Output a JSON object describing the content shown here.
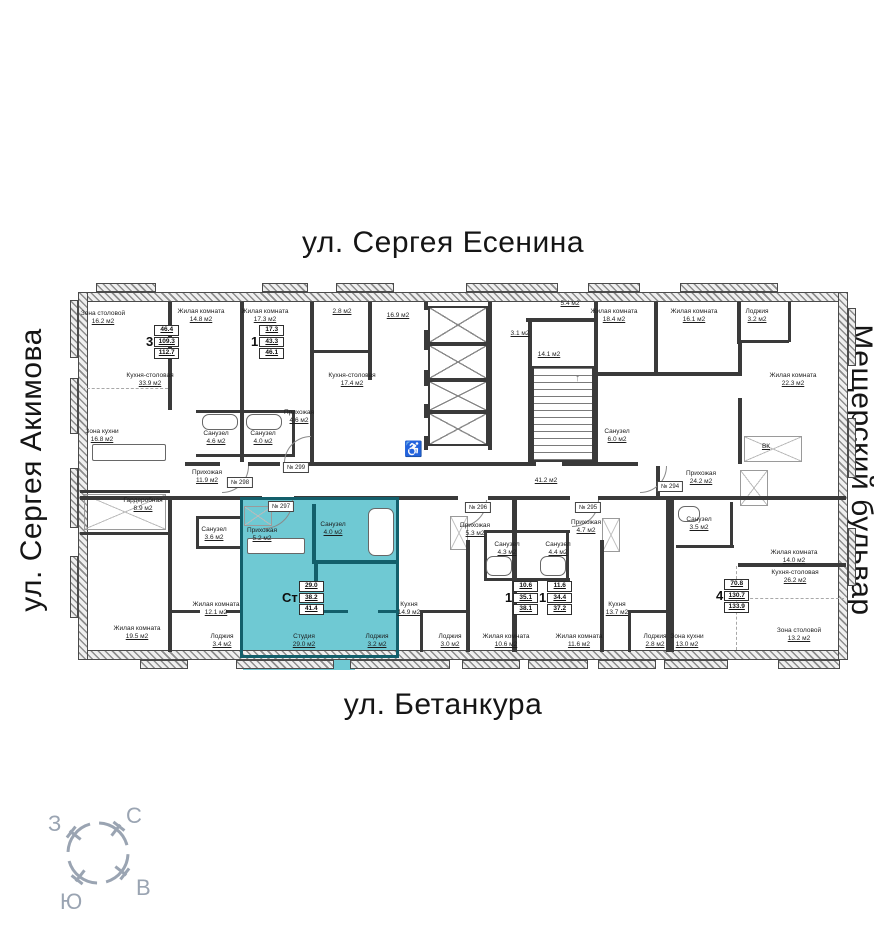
{
  "streets": {
    "top": "ул. Сергея Есенина",
    "bottom": "ул. Бетанкура",
    "left": "ул. Сергея Акимова",
    "right": "Мещерский бульвар"
  },
  "compass": {
    "north": "С",
    "south": "Ю",
    "west": "З",
    "east": "В"
  },
  "icons": {
    "wheelchair": "♿",
    "stair_arrow": "↑"
  },
  "colors": {
    "highlight_fill": "#6FC9D3",
    "highlight_wall": "#135F6B",
    "wall": "#3A3A3A",
    "accent_red": "#B31717",
    "compass_gray": "#9AA4B2"
  },
  "highlighted_unit": {
    "plate": "№ 297",
    "type": "Ст",
    "living_area": "29.0",
    "area": "38.2",
    "total_area": "41.4"
  },
  "plan": {
    "rooms": [
      {
        "n": "Зона столовой",
        "a": "16.2 м2",
        "x": 103,
        "y": 310
      },
      {
        "n": "Жилая комната",
        "a": "14.8 м2",
        "x": 201,
        "y": 308
      },
      {
        "n": "Жилая комната",
        "a": "17.3 м2",
        "x": 265,
        "y": 308
      },
      {
        "n": "",
        "a": "2.8 м2",
        "x": 342,
        "y": 308
      },
      {
        "n": "",
        "a": "16.9 м2",
        "x": 398,
        "y": 312
      },
      {
        "n": "",
        "a": "5.4 м2",
        "x": 570,
        "y": 300
      },
      {
        "n": "Жилая комната",
        "a": "18.4 м2",
        "x": 614,
        "y": 308
      },
      {
        "n": "Жилая комната",
        "a": "16.1 м2",
        "x": 694,
        "y": 308
      },
      {
        "n": "Лоджия",
        "a": "3.2 м2",
        "x": 757,
        "y": 308
      },
      {
        "n": "Кухня-столовая",
        "a": "33.9 м2",
        "x": 150,
        "y": 372
      },
      {
        "n": "Кухня-столовая",
        "a": "17.4 м2",
        "x": 352,
        "y": 372
      },
      {
        "n": "",
        "a": "3.1 м2",
        "x": 520,
        "y": 330
      },
      {
        "n": "",
        "a": "14.1 м2",
        "x": 549,
        "y": 351
      },
      {
        "n": "Жилая комната",
        "a": "22.3 м2",
        "x": 793,
        "y": 372
      },
      {
        "n": "Зона кухни",
        "a": "16.8 м2",
        "x": 102,
        "y": 428
      },
      {
        "n": "Прихожая",
        "a": "4.6 м2",
        "x": 299,
        "y": 409
      },
      {
        "n": "Санузел",
        "a": "4.6 м2",
        "x": 216,
        "y": 430
      },
      {
        "n": "Санузел",
        "a": "4.0 м2",
        "x": 263,
        "y": 430
      },
      {
        "n": "Санузел",
        "a": "6.0 м2",
        "x": 617,
        "y": 428
      },
      {
        "n": "Прихожая",
        "a": "11.9 м2",
        "x": 207,
        "y": 469
      },
      {
        "n": "",
        "a": "41.2 м2",
        "x": 546,
        "y": 477
      },
      {
        "n": "Прихожая",
        "a": "24.2 м2",
        "x": 701,
        "y": 470
      },
      {
        "n": "",
        "a": "ВК",
        "x": 766,
        "y": 443
      },
      {
        "n": "Гардеробная",
        "a": "8.9 м2",
        "x": 143,
        "y": 497
      },
      {
        "n": "Санузел",
        "a": "3.6 м2",
        "x": 214,
        "y": 526
      },
      {
        "n": "Прихожая",
        "a": "5.2 м2",
        "x": 262,
        "y": 527
      },
      {
        "n": "Санузел",
        "a": "4.0 м2",
        "x": 333,
        "y": 521
      },
      {
        "n": "Санузел",
        "a": "3.5 м2",
        "x": 699,
        "y": 516
      },
      {
        "n": "Прихожая",
        "a": "5.3 м2",
        "x": 475,
        "y": 522
      },
      {
        "n": "Прихожая",
        "a": "4.7 м2",
        "x": 586,
        "y": 519
      },
      {
        "n": "Санузел",
        "a": "4.3 м2",
        "x": 507,
        "y": 541
      },
      {
        "n": "Санузел",
        "a": "4.4 м2",
        "x": 558,
        "y": 541
      },
      {
        "n": "Жилая комната",
        "a": "14.0 м2",
        "x": 794,
        "y": 549
      },
      {
        "n": "Кухня-столовая",
        "a": "26.2 м2",
        "x": 795,
        "y": 569
      },
      {
        "n": "Жилая комната",
        "a": "12.1 м2",
        "x": 216,
        "y": 601
      },
      {
        "n": "Кухня",
        "a": "14.9 м2",
        "x": 409,
        "y": 601
      },
      {
        "n": "Кухня",
        "a": "13.7 м2",
        "x": 617,
        "y": 601
      },
      {
        "n": "Жилая комната",
        "a": "19.5 м2",
        "x": 137,
        "y": 625
      },
      {
        "n": "Лоджия",
        "a": "3.4 м2",
        "x": 222,
        "y": 633
      },
      {
        "n": "Студия",
        "a": "29.0 м2",
        "x": 304,
        "y": 633
      },
      {
        "n": "Лоджия",
        "a": "3.2 м2",
        "x": 377,
        "y": 633
      },
      {
        "n": "Лоджия",
        "a": "3.0 м2",
        "x": 450,
        "y": 633
      },
      {
        "n": "Жилая комната",
        "a": "10.6 м2",
        "x": 506,
        "y": 633
      },
      {
        "n": "Жилая комната",
        "a": "11.6 м2",
        "x": 579,
        "y": 633
      },
      {
        "n": "Лоджия",
        "a": "2.8 м2",
        "x": 655,
        "y": 633
      },
      {
        "n": "Зона кухни",
        "a": "13.0 м2",
        "x": 687,
        "y": 633
      },
      {
        "n": "Зона столовой",
        "a": "13.2 м2",
        "x": 799,
        "y": 627
      }
    ],
    "plates": [
      {
        "t": "№ 294",
        "x": 670,
        "y": 481
      },
      {
        "t": "№ 295",
        "x": 588,
        "y": 502
      },
      {
        "t": "№ 296",
        "x": 478,
        "y": 502
      },
      {
        "t": "№ 297",
        "x": 281,
        "y": 501
      },
      {
        "t": "№ 298",
        "x": 240,
        "y": 477
      },
      {
        "t": "№ 299",
        "x": 296,
        "y": 462
      }
    ],
    "info_boxes": [
      {
        "t": "3",
        "vals": [
          "46.4",
          "109.3",
          "112.7"
        ],
        "x": 146,
        "y": 325,
        "hl": false
      },
      {
        "t": "1",
        "vals": [
          "17.3",
          "43.3",
          "46.1"
        ],
        "x": 251,
        "y": 325,
        "hl": false
      },
      {
        "t": "Ст",
        "vals": [
          "29.0",
          "38.2",
          "41.4"
        ],
        "x": 282,
        "y": 581,
        "hl": true
      },
      {
        "t": "1",
        "vals": [
          "10.6",
          "35.1",
          "38.1"
        ],
        "x": 505,
        "y": 581,
        "hl": false
      },
      {
        "t": "1",
        "vals": [
          "11.6",
          "34.4",
          "37.2"
        ],
        "x": 539,
        "y": 581,
        "hl": false
      },
      {
        "t": "4",
        "vals": [
          "70.8",
          "130.7",
          "133.9"
        ],
        "x": 716,
        "y": 579,
        "hl": false
      }
    ]
  }
}
